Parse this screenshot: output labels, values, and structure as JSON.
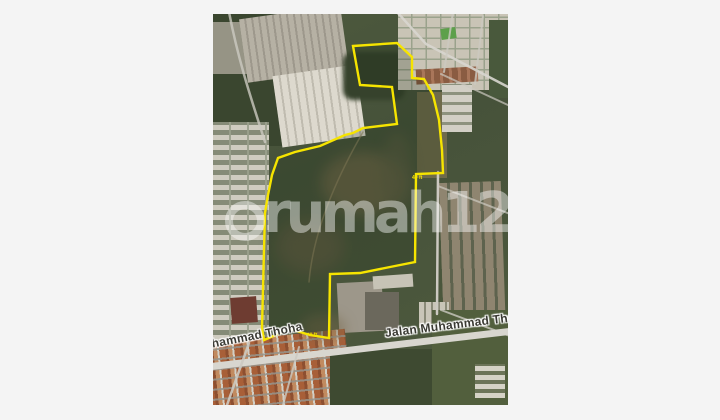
{
  "page": {
    "background": "#f4f4f4"
  },
  "map": {
    "type": "satellite-photo",
    "watermark": {
      "text": "rumah123"
    },
    "street_labels": [
      {
        "id": "bottom-left",
        "text": "Jalan Muhammad Thoha"
      },
      {
        "id": "bottom-right",
        "text": "Jalan Muhammad Thoha"
      }
    ],
    "measurement_labels": [
      {
        "text": "40 ft"
      },
      {
        "text": "40 ft"
      }
    ],
    "polygon": {
      "stroke_color": "#f6e400",
      "points": "140,32 184,29 199,43 199,64 211,65 220,81 226,106 229,136 230,159 203,160 202,248 177,253 147,259 117,260 116,324 97,321 77,315 51,326 49,314 51,236 52,199 55,181 59,161 65,144 82,138 107,132 132,121 140,119 150,114 184,110 179,73 147,71"
    },
    "colors": {
      "field_green": "#48543a",
      "road_gray": "#d8d6cf",
      "roof_orange": "#a85f38",
      "boundary_yellow": "#f6e400",
      "watermark_white": "rgba(255,255,255,0.44)"
    }
  }
}
